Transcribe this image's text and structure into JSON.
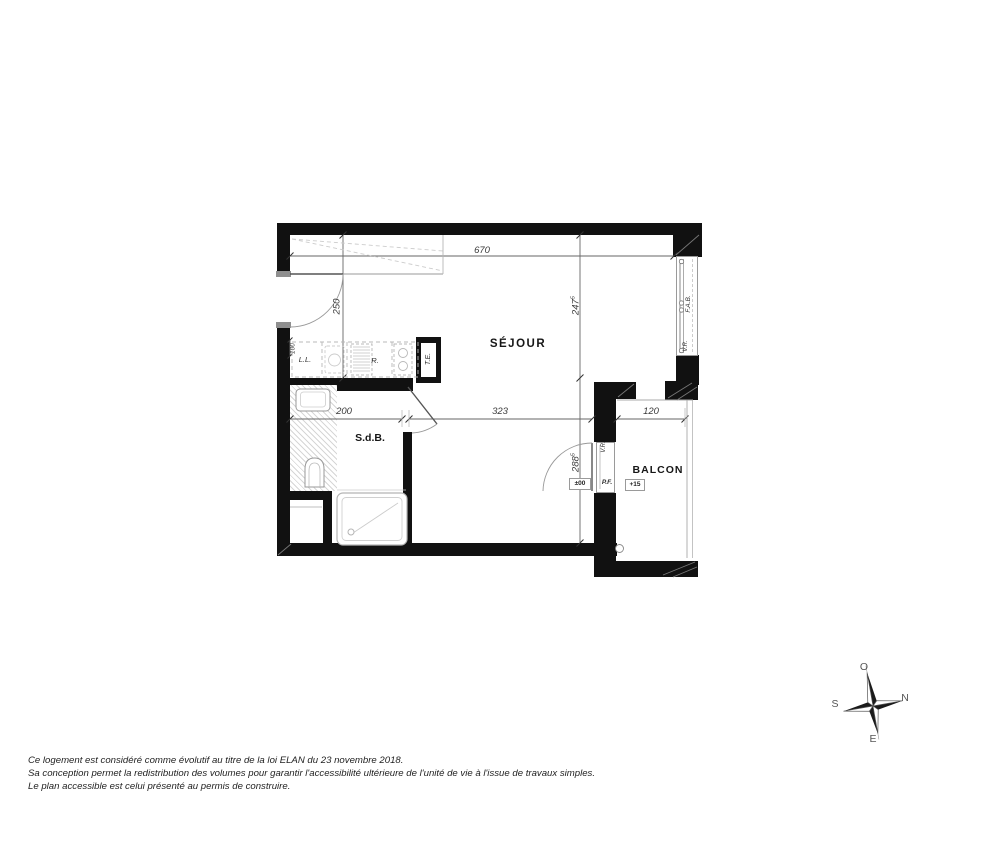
{
  "plan": {
    "room_labels": {
      "sejour": "SÉJOUR",
      "sdb": "S.d.B.",
      "balcon": "BALCON"
    },
    "dimensions": {
      "total_width": "670",
      "entry_depth": "250",
      "sejour_height_main": "247",
      "sejour_height_sup": "5",
      "lower_height_main": "288",
      "lower_height_sup": "5",
      "sdb_width": "200",
      "sejour_width": "323",
      "balcon_width": "120",
      "niche_width": "100"
    },
    "annotations": {
      "washing_machine": "L.L.",
      "fridge": "R.",
      "electrical_panel": "T.E.",
      "window": "F.A.B.",
      "shutter_window": "V.R.",
      "shutter_door": "V.R.",
      "french_door": "P.F.",
      "level_interior": "±00",
      "level_balcony": "+15"
    }
  },
  "compass": {
    "west": "O",
    "north": "N",
    "south": "S",
    "east": "E"
  },
  "footer": {
    "line1": "Ce logement est considéré comme évolutif au titre de la loi ELAN du 23 novembre 2018.",
    "line2": "Sa conception permet la redistribution des volumes pour garantir l'accessibilité ultérieure de l'unité de vie à l'issue de travaux simples.",
    "line3": "Le plan accessible est celui présenté au permis de construire."
  }
}
